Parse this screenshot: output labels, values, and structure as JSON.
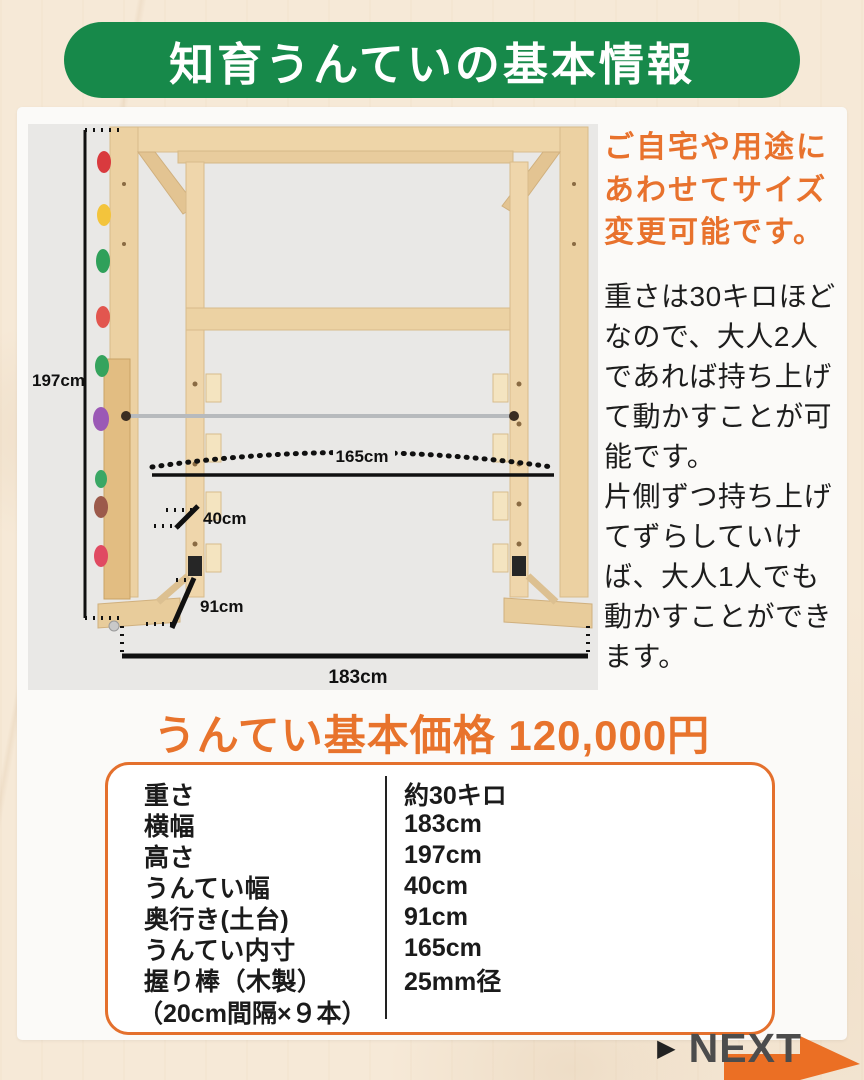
{
  "colors": {
    "header_green": "#17894a",
    "accent_orange": "#e8722d",
    "body_text": "#1d1d1d",
    "next_gray": "#4c4c4c",
    "photo_bg": "#e9e8e6",
    "page_bg": "#f6e9d7"
  },
  "header": {
    "title": "知育うんていの基本情報"
  },
  "diagram": {
    "dims": {
      "height": "197cm",
      "inner_width": "165cm",
      "rung_width": "40cm",
      "base_depth": "91cm",
      "total_width": "183cm"
    },
    "subject": "wooden-monkey-bars-with-climbing-holds"
  },
  "side_note": {
    "highlight": "ご自宅や用途にあわせてサイズ変更可能です。",
    "body1": "重さは30キロほどなので、大人2人であれば持ち上げて動かすことが可能です。",
    "body2": "片側ずつ持ち上げてずらしていけば、大人1人でも動かすことができます。"
  },
  "price": {
    "title": "うんてい基本価格 120,000円"
  },
  "specs": {
    "rows": [
      {
        "label": "重さ",
        "value": "約30キロ"
      },
      {
        "label": "横幅",
        "value": "183cm"
      },
      {
        "label": "高さ",
        "value": "197cm"
      },
      {
        "label": "うんてい幅",
        "value": "40cm"
      },
      {
        "label": "奥行き(土台)",
        "value": "91cm"
      },
      {
        "label": "うんてい内寸",
        "value": "165cm"
      },
      {
        "label": "握り棒（木製）",
        "value": "25mm径",
        "value2": "（20cm間隔×９本）"
      }
    ]
  },
  "next": {
    "pointer": "▶",
    "label": "NEXT"
  }
}
